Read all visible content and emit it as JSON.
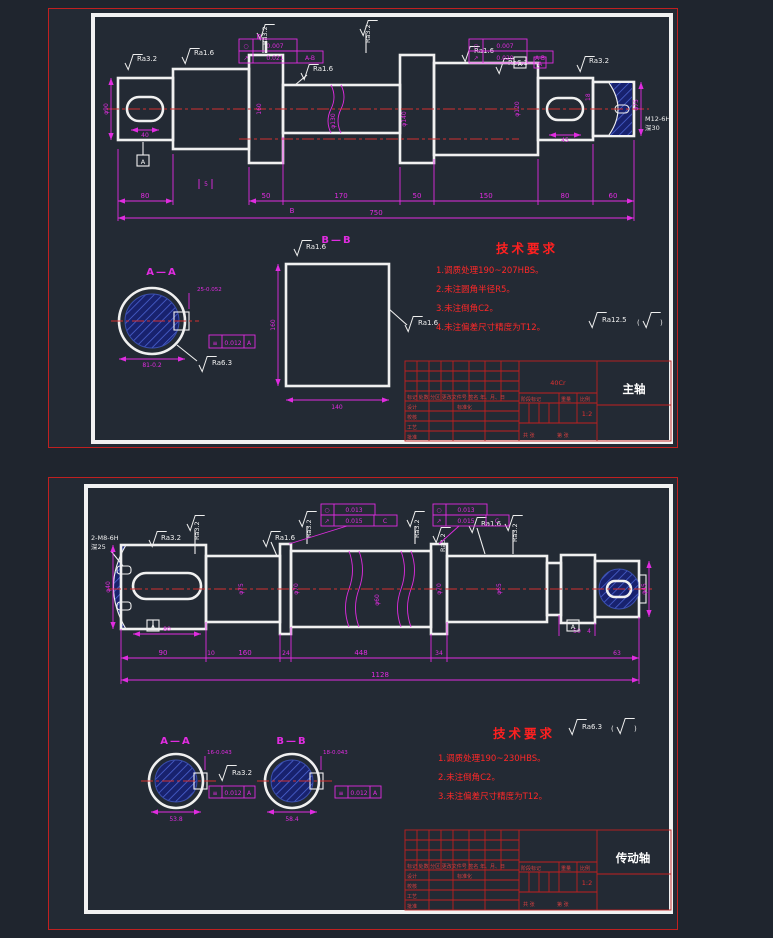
{
  "sheet1": {
    "name_plate": "主轴",
    "material": "40Cr",
    "scale": "1:2",
    "tech": {
      "title": "技术要求",
      "i1": "1.调质处理190~207HBS。",
      "i2": "2.未注圆角半径R5。",
      "i3": "3.未注倒角C2。",
      "i4": "4.未注偏差尺寸精度为T12。",
      "ra_other": "Ra12.5",
      "paren_l": "(",
      "paren_r": ")"
    },
    "chain": {
      "d1": "80",
      "d2": "50",
      "d3": "170",
      "d4": "50",
      "d5": "150",
      "d6": "80",
      "d7": "60",
      "overall": "750",
      "step": "5",
      "key_len": "40",
      "key_w": "18",
      "key_len_r": "45"
    },
    "dia": {
      "v1": "φ90",
      "v2": "160",
      "v3": "φ130",
      "v4": "φ140",
      "v5": "φ120",
      "v6": "φ75"
    },
    "thread": {
      "l1": "M12-6H",
      "l2": "深30"
    },
    "ra": {
      "r1": "Ra3.2",
      "r2": "Ra1.6",
      "r3": "Ra1.6",
      "r4": "Ra3.2",
      "r5": "Ra3.2",
      "r6": "Ra1.6",
      "r7": "Ra6.3",
      "r8": "Ra3.2"
    },
    "fcf1": {
      "s1": "○",
      "v1": "0.007",
      "s2": "↗",
      "v2": "0.021",
      "d2": "A-B"
    },
    "fcf2": {
      "s1": "○",
      "v1": "0.007",
      "s2": "↗",
      "v2": "0.020",
      "d2": "A-B"
    },
    "datums": {
      "a": "A",
      "b": "B"
    },
    "secA": {
      "title": "A—A",
      "top": "25-0.052",
      "bot": "81-0.2",
      "fs": "≡",
      "fv": "0.012",
      "fd": "A",
      "ra": "Ra6.3"
    },
    "secB": {
      "title": "B—B",
      "h": "160",
      "w": "140",
      "ra": "Ra1.6",
      "ra2": "Ra1.6"
    }
  },
  "sheet2": {
    "name_plate": "传动轴",
    "scale": "1:2",
    "tech": {
      "title": "技术要求",
      "i1": "1.调质处理190~230HBS。",
      "i2": "2.未注倒角C2。",
      "i3": "3.未注偏差尺寸精度为T12。",
      "ra_other": "Ra6.3",
      "paren_l": "(",
      "paren_r": ")"
    },
    "chain": {
      "d1": "90",
      "d2": "10",
      "d3": "160",
      "d4": "24",
      "d5": "448",
      "d6": "34",
      "d7": "4",
      "d8": "50",
      "d9": "63",
      "overall": "1128",
      "key_len": "80"
    },
    "dia": {
      "v1": "φ40",
      "v2": "φ75",
      "v3": "φ70",
      "v4": "φ60",
      "v5": "φ70",
      "v6": "φ65",
      "v7": "φ45"
    },
    "thread": {
      "l1": "2-M8-6H",
      "l2": "深25"
    },
    "ra": {
      "r1": "Ra3.2",
      "r2": "Ra3.2",
      "r3": "Ra1.6",
      "r4": "Ra3.2",
      "r5": "Ra3.2",
      "r6": "Ra3.2",
      "r7": "Ra1.6",
      "r8": "Ra3.2"
    },
    "fcf1": {
      "s1": "○",
      "v1": "0.013",
      "s2": "↗",
      "v2": "0.015",
      "d2": "C"
    },
    "fcf2": {
      "s1": "○",
      "v1": "0.013",
      "s2": "↗",
      "v2": "0.015",
      "d2": "C"
    },
    "datum": "A",
    "secA": {
      "title": "A—A",
      "top": "16-0.043",
      "bot": "53.8",
      "fs": "≡",
      "fv": "0.012",
      "fd": "A",
      "ra": "Ra3.2"
    },
    "secB": {
      "title": "B—B",
      "top": "18-0.043",
      "bot": "58.4",
      "fs": "≡",
      "fv": "0.012",
      "fd": "A"
    }
  },
  "title_block": {
    "mark_row": "标记 处数 分区 更改文件号 签名 年、月、日",
    "design": "设计",
    "check": "校核",
    "process": "工艺",
    "approve": "批准",
    "standard": "标准化",
    "stage": "阶段标记",
    "weight": "重量",
    "ratio": "比例",
    "total": "共 张",
    "page": "第 张"
  }
}
